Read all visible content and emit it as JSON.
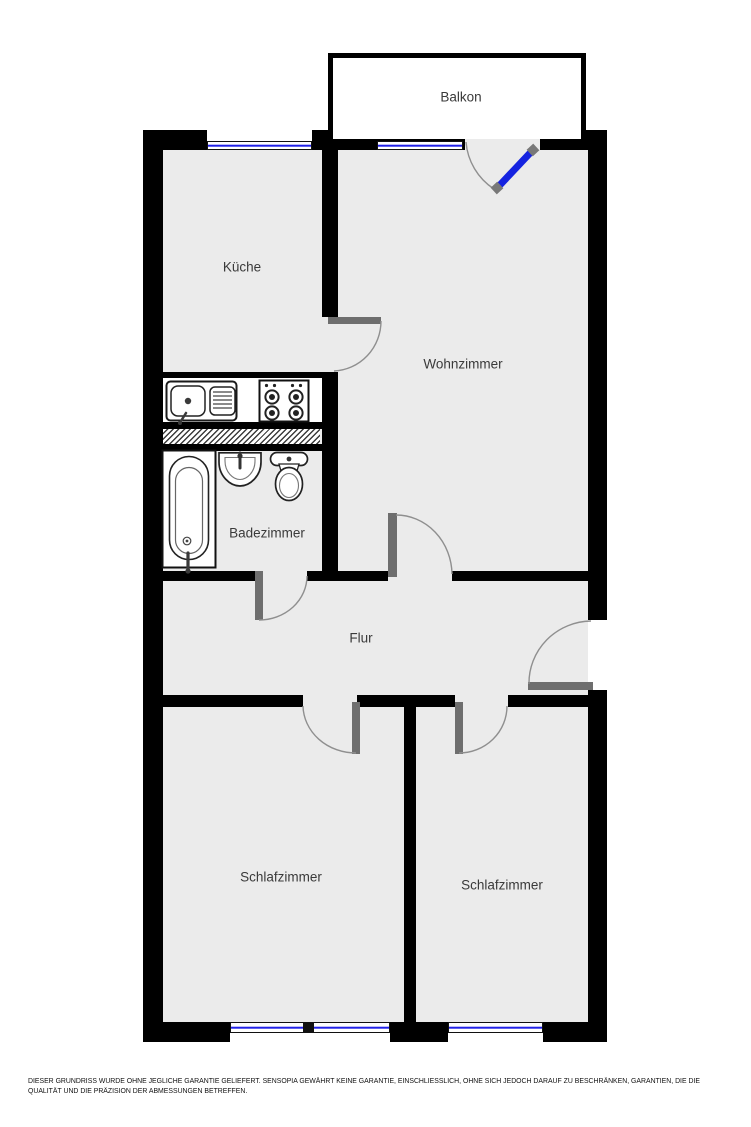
{
  "plan": {
    "rooms": {
      "balkon": {
        "label": "Balkon"
      },
      "kueche": {
        "label": "Küche"
      },
      "wohnzimmer": {
        "label": "Wohnzimmer"
      },
      "badezimmer": {
        "label": "Badezimmer"
      },
      "flur": {
        "label": "Flur"
      },
      "schlafzimmer_links": {
        "label": "Schlafzimmer"
      },
      "schlafzimmer_rechts": {
        "label": "Schlafzimmer"
      }
    },
    "fixtures": [
      "kitchen-sink",
      "stove",
      "bathtub",
      "washbasin",
      "toilet",
      "ventilation-shaft"
    ],
    "colors": {
      "wall": "#000000",
      "floor": "#ebebeb",
      "balcony_floor": "#ffffff",
      "window_glass": "#2121e8",
      "balcony_door": "#1523e0",
      "door_panel": "#6e6e6e",
      "door_swing": "#8f8f8f",
      "label_text": "#3a3a3a"
    },
    "footer": {
      "disclaimer": "DIESER GRUNDRISS WURDE OHNE JEGLICHE GARANTIE GELIEFERT. SENSOPIA GEWÄHRT KEINE GARANTIE, EINSCHLIESSLICH, OHNE SICH JEDOCH DARAUF ZU BESCHRÄNKEN, GARANTIEN, DIE DIE QUALITÄT UND DIE PRÄZISION DER ABMESSUNGEN BETREFFEN."
    }
  }
}
